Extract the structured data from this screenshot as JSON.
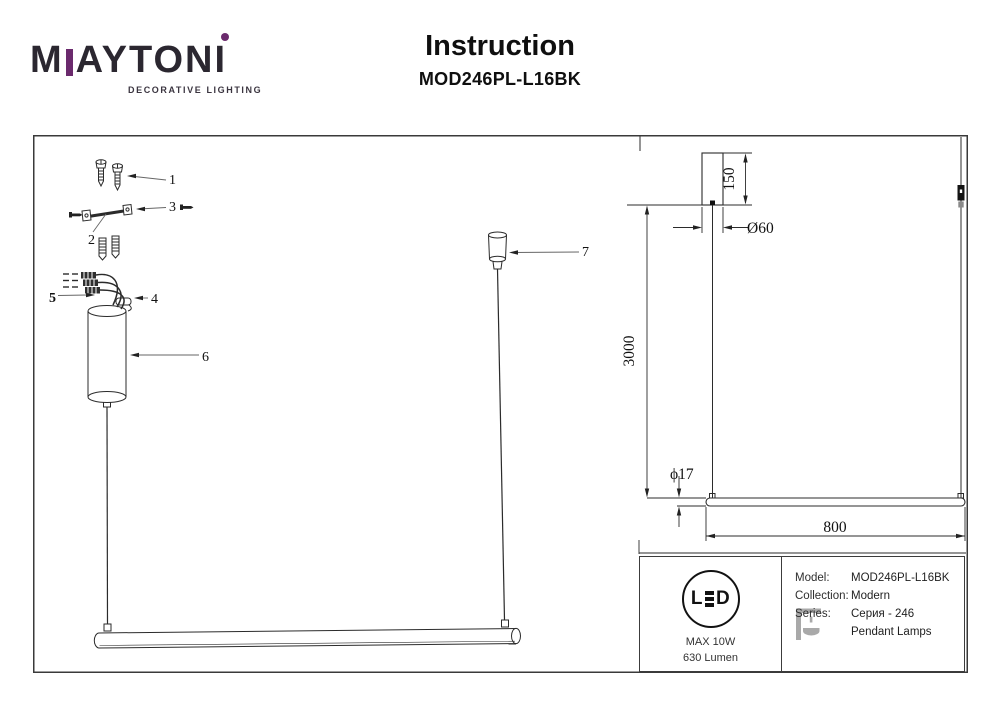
{
  "header": {
    "brand": {
      "wordmark_m": "M",
      "wordmark_mid": "AYTON",
      "wordmark_i": "I",
      "tagline": "DECORATIVE LIGHTING",
      "accent_color": "#6b2a6d"
    },
    "title": "Instruction",
    "model": "MOD246PL-L16BK"
  },
  "diagram": {
    "part_labels": [
      "1",
      "2",
      "3",
      "4",
      "5",
      "6",
      "7"
    ],
    "dimensions": {
      "canopy_height": "150",
      "canopy_diameter": "Ø60",
      "suspension_length": "3000",
      "tube_diameter": "ϕ17",
      "tube_length": "800"
    }
  },
  "info_panel": {
    "led_badge": {
      "l": "L",
      "d": "D",
      "power": "MAX 10W",
      "lumen": "630 Lumen"
    },
    "specs": [
      {
        "label": "Model:",
        "value": "MOD246PL-L16BK"
      },
      {
        "label": "Collection:",
        "value": "Modern"
      },
      {
        "label": "Series:",
        "value": "Серия - 246"
      },
      {
        "label": "",
        "value": "Pendant Lamps"
      }
    ]
  }
}
